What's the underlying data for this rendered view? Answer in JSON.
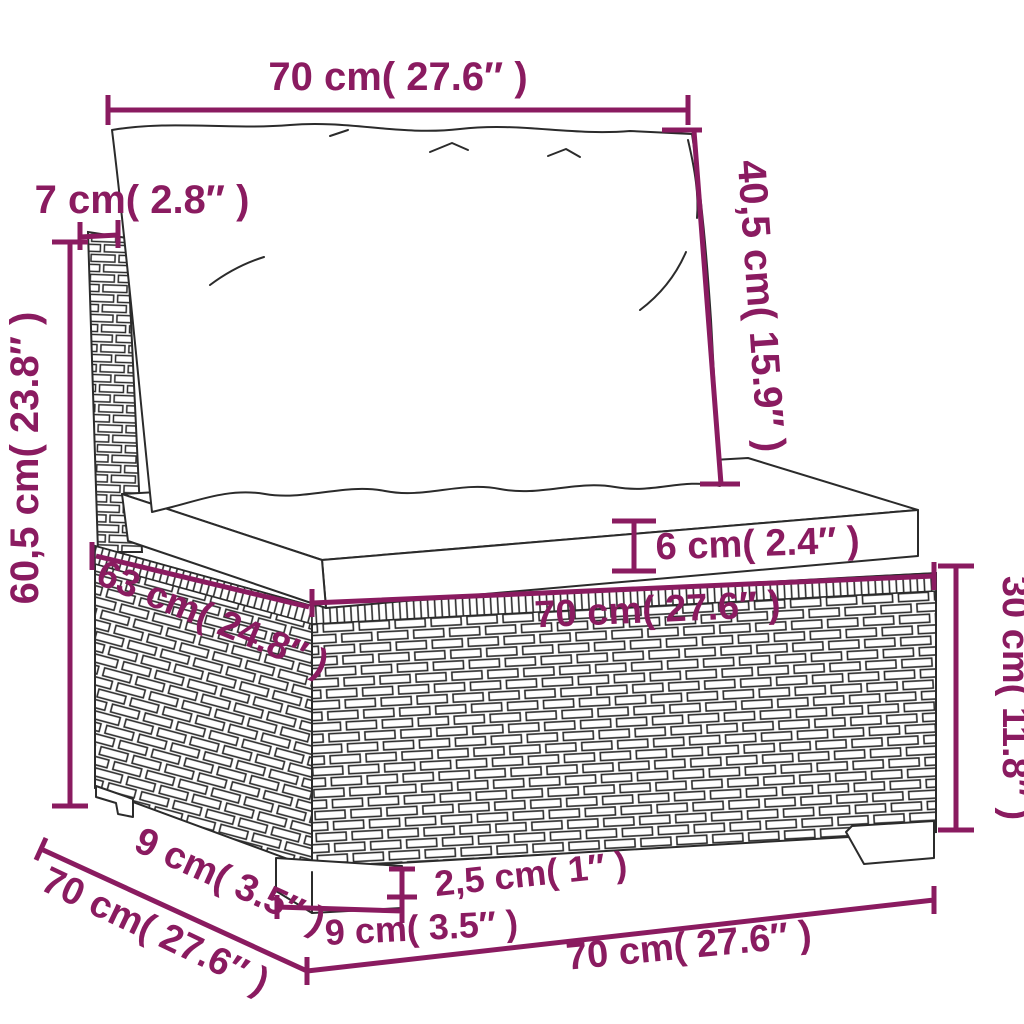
{
  "title": "Rattan sofa section dimension diagram",
  "colors": {
    "dimension": "#8a1b60",
    "line": "#2b2b2b",
    "background": "#ffffff"
  },
  "dimensions": {
    "back_width": "70 cm( 27.6″ )",
    "back_cushion_height": "40,5 cm( 15.9″ )",
    "back_post_width": "7 cm( 2.8″ )",
    "total_height": "60,5 cm( 23.8″ )",
    "seat_cushion_thickness": "6 cm( 2.4″ )",
    "seat_depth": "63 cm( 24.8″ )",
    "seat_width": "70 cm( 27.6″ )",
    "base_height": "30 cm( 11.8″ )",
    "foot_height": "2,5 cm( 1″ )",
    "foot_width": "9 cm( 3.5″ )",
    "foot_inset_depth": "9 cm( 3.5″ )",
    "base_depth": "70 cm( 27.6″ )",
    "base_width": "70 cm( 27.6″ )"
  }
}
